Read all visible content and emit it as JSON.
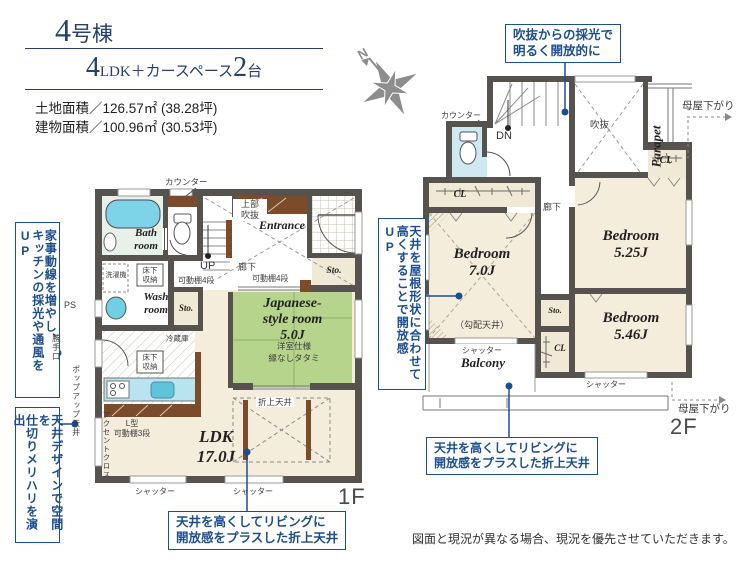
{
  "header": {
    "title_num": "4",
    "title_suffix": "号棟",
    "plan_num1": "4",
    "plan_mid": "LDK＋カースペース",
    "plan_num2": "2",
    "plan_tail": "台",
    "land_area": "土地面積／126.57㎡ (38.28坪)",
    "building_area": "建物面積／100.96㎡ (30.53坪)"
  },
  "callouts": {
    "left1": {
      "c1": "家事動線を増やし、",
      "c2": "キッチンの採光や通風をUP"
    },
    "left2": {
      "c1": "天井デザインで空間を",
      "c2": "仕切りメリハリを演出"
    },
    "void_light": "吹抜からの採光で\n明るく開放的に",
    "roof": {
      "c1": "天井を屋根形状に合わせて",
      "c2": "高くすることで開放感UP"
    },
    "ceiling_1f": "天井を高くしてリビングに\n開放感をプラスした折上天井",
    "ceiling_2f": "天井を高くしてリビングに\n開放感をプラスした折上天井"
  },
  "f1": {
    "counter": "カウンター",
    "bath": "Bath\nroom",
    "upper_void": "上部\n吹抜",
    "entrance": "Entrance",
    "up": "UP",
    "hallway": "廊下",
    "shelf4_a": "可動棚4段",
    "shelf4_b": "可動棚4段",
    "washer": "洗濯機",
    "underfloor_a": "床下\n収納",
    "underfloor_b": "床下\n収納",
    "wash": "Wash\nroom",
    "sto_a": "Sto.",
    "sto_b": "Sto.",
    "jroom": "Japanese-\nstyle room\n5.0J",
    "jroom_spec1": "洋室仕様",
    "jroom_spec2": "縁なしタタミ",
    "fridge": "冷蔵庫",
    "l_shelf": "L型\n可動棚3段",
    "accent": "アクセントクロス",
    "ldk": "LDK\n17.0J",
    "coffered": "折上天井",
    "shutter_a": "シャッター",
    "shutter_b": "シャッター",
    "popup": "ポップアップ天井",
    "backdoor": "勝手口",
    "ps": "PS",
    "floor": "1F"
  },
  "f2": {
    "counter": "カウンター",
    "dn": "DN",
    "void": "吹抜",
    "parapet": "Parapet",
    "moya_top": "母屋下がり",
    "cl_left": "CL",
    "cl_topright": "CL",
    "cl_mid": "CL",
    "hallway": "廊下",
    "bed7": "Bedroom\n7.0J",
    "sloped": "（勾配天井）",
    "bed525": "Bedroom\n5.25J",
    "bed546": "Bedroom\n5.46J",
    "sto": "Sto.",
    "balcony": "Balcony",
    "shutter_a": "シャッター",
    "shutter_b": "シャッター",
    "moya_bottom": "母屋下がり",
    "floor": "2F"
  },
  "compass_n": "N",
  "disclaimer": "図面と現況が異なる場合、現況を優先させていただきます。"
}
